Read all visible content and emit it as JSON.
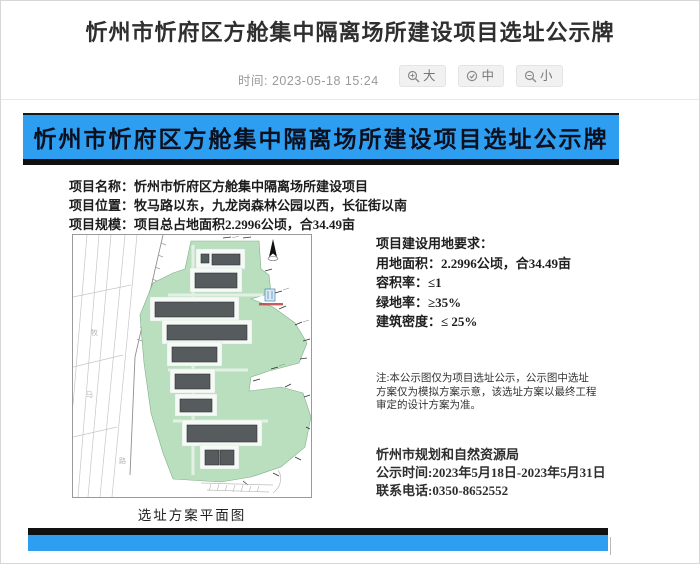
{
  "page": {
    "title": "忻州市忻府区方舱集中隔离场所建设项目选址公示牌",
    "meta": {
      "time_label": "时间:",
      "time_value": "2023-05-18 15:24"
    },
    "font_controls": [
      {
        "label": "大"
      },
      {
        "label": "中"
      },
      {
        "label": "小"
      }
    ]
  },
  "board": {
    "banner_title": "忻州市忻府区方舱集中隔离场所建设项目选址公示牌",
    "info": [
      {
        "label": "项目名称：",
        "value": "忻州市忻府区方舱集中隔离场所建设项目"
      },
      {
        "label": "项目位置：",
        "value": "牧马路以东，九龙岗森林公园以西，长征街以南"
      },
      {
        "label": "项目规模：",
        "value": "项目总占地面积2.2996公顷，合34.49亩"
      }
    ],
    "map": {
      "caption": "选址方案平面图",
      "road_chars": [
        "牧",
        "马",
        "路"
      ]
    },
    "requirements": {
      "title": "项目建设用地要求：",
      "items": [
        {
          "label": "用地面积：",
          "value": "2.2996公顷，合34.49亩"
        },
        {
          "label": "容积率：",
          "value": "≤1"
        },
        {
          "label": "绿地率：",
          "value": "≥35%"
        },
        {
          "label": "建筑密度：",
          "value": "≤ 25%"
        }
      ]
    },
    "note": "注:本公示图仅为项目选址公示，公示图中选址方案仅为模拟方案示意，该选址方案以最终工程审定的设计方案为准。",
    "agency": "忻州市规划和自然资源局",
    "publicity_period": "公示时间:2023年5月18日-2023年5月31日",
    "contact_phone": "联系电话:0350-8652552"
  },
  "colors": {
    "banner_blue": "#2e9ef0",
    "bar_black": "#101010",
    "map_green": "#b9dfbf",
    "building_gray": "#565b5e"
  }
}
